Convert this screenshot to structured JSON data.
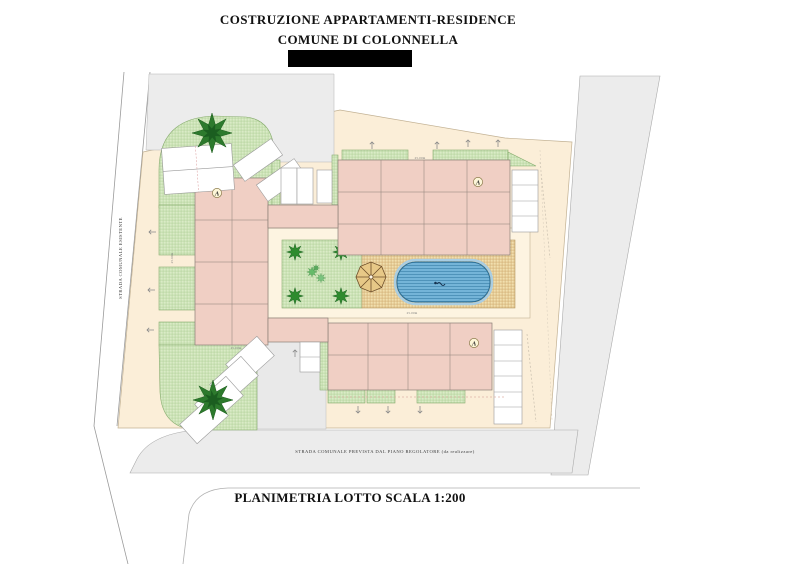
{
  "header": {
    "title_line1": "COSTRUZIONE APPARTAMENTI-RESIDENCE",
    "title_line2": "COMUNE DI COLONNELLA"
  },
  "plan": {
    "left_road_label": "STRADA COMUNALE ESISTENTE",
    "bottom_road_label": "STRADA COMUNALE PREVISTA DAL PIANO REGOLATORE (da realizzare)",
    "block_label": "A",
    "dims": {
      "top": "25.00m",
      "courtyard": "25.00m",
      "left": "25.00m",
      "bottom_left": "25.00m"
    },
    "colors": {
      "lot": "#fbeed8",
      "building": "#f0cfc4",
      "green": "#d9eac6",
      "paving": "#f3e3b8",
      "pool": "#74b4d8",
      "road": "#ececec",
      "redaction": "#000000"
    }
  },
  "footer": {
    "caption": "PLANIMETRIA LOTTO SCALA 1:200"
  }
}
